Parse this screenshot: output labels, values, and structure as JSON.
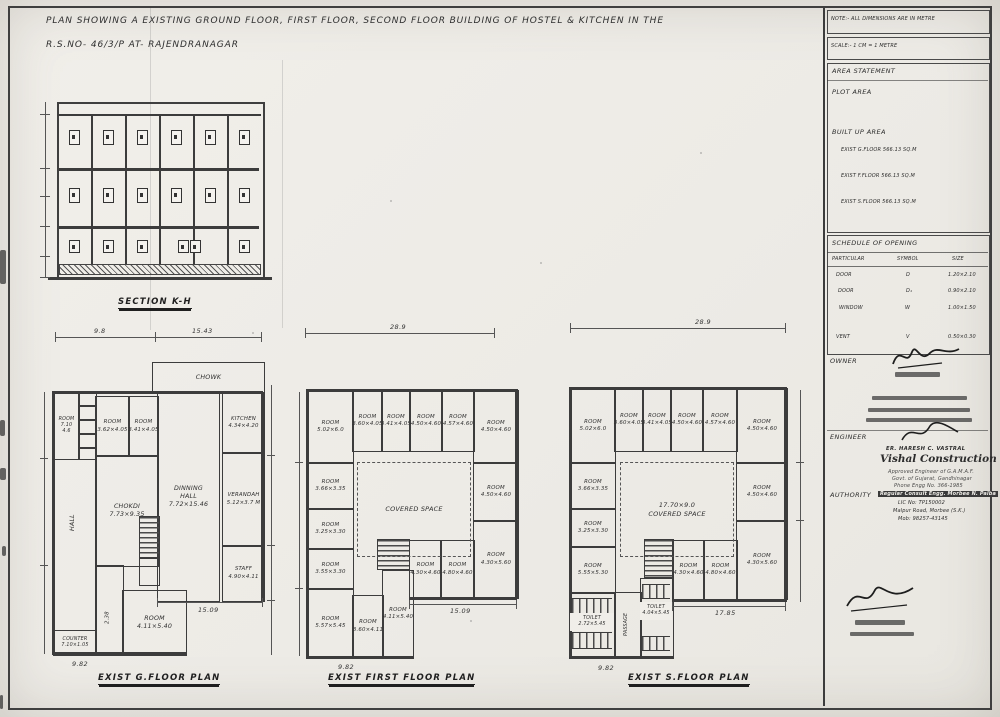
{
  "sheet": {
    "title_line1": "PLAN SHOWING A EXISTING GROUND FLOOR, FIRST FLOOR, SECOND FLOOR BUILDING OF HOSTEL & KITCHEN IN THE",
    "title_line2": "R.S.NO- 46/3/P AT- RAJENDRANAGAR"
  },
  "section": {
    "label": "SECTION K-H"
  },
  "plans": {
    "ground": {
      "label": "EXIST G.FLOOR PLAN",
      "dims": {
        "top_left": "9.8",
        "top_right": "15.43",
        "mid": "15.09",
        "bottom_left": "9.82"
      },
      "rooms": {
        "chowk": "CHOWK",
        "room_a": "ROOM\n7.10\n4.6",
        "room_362": "ROOM\n3.62×4.05",
        "room_341": "ROOM\n3.41×4.05",
        "kitchen": "KITCHEN\n4.34×4.20",
        "dinning_hall": "DINNING\nHALL\n7.72×15.46",
        "chokdi": "CHOKDI\n7.73×9.35",
        "verandah": "VERANDAH\n5.12×3.7 M",
        "hall": "HALL",
        "staff": "STAFF\n4.90×4.11",
        "room_411": "ROOM\n4.11×5.40",
        "counter": "COUNTER\n7.10×1.05",
        "corridor": "2.38"
      }
    },
    "first": {
      "label": "EXIST FIRST FLOOR PLAN",
      "dims": {
        "top": "28.9",
        "mid": "15.09",
        "bottom_left": "9.82"
      },
      "rooms": {
        "t1": "ROOM\n5.02×6.0",
        "t2": "ROOM\n3.60×4.05",
        "t3": "ROOM\n3.41×4.05",
        "t4": "ROOM\n4.50×4.60",
        "t5": "ROOM\n4.57×4.60",
        "t6": "ROOM\n4.50×4.60",
        "l1": "ROOM\n3.66×3.35",
        "l2": "ROOM\n3.25×3.30",
        "l3": "ROOM\n3.55×3.30",
        "l4": "ROOM\n5.57×5.45",
        "b1": "ROOM\n3.60×4.11",
        "b2": "ROOM\n4.11×5.40",
        "r1": "ROOM\n4.50×4.60",
        "r2": "ROOM\n4.30×5.60",
        "w1": "ROOM\n4.30×4.60",
        "w2": "ROOM\n4.80×4.60",
        "covered": "COVERED SPACE"
      }
    },
    "second": {
      "label": "EXIST S.FLOOR PLAN",
      "dims": {
        "top": "28.9",
        "mid": "17.85",
        "bottom_left": "9.82"
      },
      "rooms": {
        "t1": "ROOM\n5.02×6.0",
        "t2": "ROOM\n3.60×4.05",
        "t3": "ROOM\n3.41×4.05",
        "t4": "ROOM\n4.50×4.60",
        "t5": "ROOM\n4.57×4.60",
        "t6": "ROOM\n4.50×4.60",
        "l1": "ROOM\n3.66×3.35",
        "l2": "ROOM\n3.25×3.30",
        "l3": "ROOM\n5.55×5.30",
        "toilet1": "TOILET\n2.72×5.45",
        "toilet2": "TOILET\n4.04×5.45",
        "passage": "PASSAGE",
        "r1": "ROOM\n4.50×4.60",
        "r2": "ROOM\n4.30×5.60",
        "w1": "ROOM\n4.30×4.60",
        "w2": "ROOM\n4.80×4.60",
        "covered": "17.70×9.0\nCOVERED SPACE"
      }
    }
  },
  "titleblock": {
    "note": "NOTE:- ALL DIMENSIONS ARE IN METRE",
    "scale": "SCALE:- 1 CM = 1 METRE",
    "area": {
      "heading": "AREA STATEMENT",
      "plot": "PLOT AREA",
      "builtup": "BUILT UP AREA",
      "rows": [
        "EXIST G.FLOOR  566.13 SQ.M",
        "EXIST F.FLOOR  566.13 SQ.M",
        "EXIST S.FLOOR  566.13 SQ.M"
      ]
    },
    "schedule": {
      "heading": "SCHEDULE OF OPENING",
      "col_particular": "PARTICULAR",
      "col_symbol": "SYMBOL",
      "col_size": "SIZE",
      "rows": [
        {
          "particular": "DOOR",
          "symbol": "D",
          "size": "1.20×2.10"
        },
        {
          "particular": "DOOR",
          "symbol": "D₁",
          "size": "0.90×2.10"
        },
        {
          "particular": "WINDOW",
          "symbol": "W",
          "size": "1.00×1.50"
        },
        {
          "particular": "VENT",
          "symbol": "V",
          "size": "0.50×0.30"
        }
      ]
    },
    "owner_label": "OWNER",
    "engineer_label": "ENGINEER",
    "engineer": {
      "name": "ER. HARESH C. VASTRAL",
      "firm": "Vishal Construction",
      "line1": "Approved Engineer of G.A.M.A.F.",
      "line2": "Govt. of Gujarat, Gandhinagar",
      "line3": "Phone Engg No. 366-1985"
    },
    "authority_label": "AUTHORITY",
    "authority": {
      "line1": "Regular Consult Engg. Morbee N. Palba",
      "line2": "LIC No: TP150002",
      "line3": "Malpur Road, Morbee (S.K.)",
      "line4": "Mob: 98257-43145"
    }
  }
}
